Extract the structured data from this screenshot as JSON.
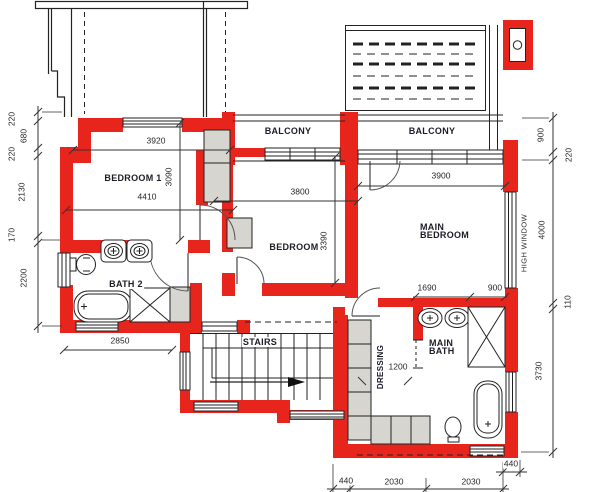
{
  "labels": {
    "bedroom1": "BEDROOM 1",
    "bedroom2": "BEDROOM 2",
    "main_bedroom_line1": "MAIN",
    "main_bedroom_line2": "BEDROOM",
    "bath2": "BATH 2",
    "main_bath_line1": "MAIN",
    "main_bath_line2": "BATH",
    "balcony_left": "BALCONY",
    "balcony_right": "BALCONY",
    "stairs": "STAIRS",
    "dressing": "DRESSING",
    "high_window": "HIGH WINDOW"
  },
  "dims": {
    "left": [
      "220",
      "680",
      "220",
      "2130",
      "170",
      "2200"
    ],
    "right": [
      "900",
      "220",
      "4000",
      "110",
      "3730"
    ],
    "bottom": [
      "440",
      "2030",
      "2030",
      "440"
    ],
    "bedroom1_top_wall": "3920",
    "bedroom1_width": "4410",
    "bedroom1_depth": "3090",
    "bedroom2_width": "3800",
    "bedroom2_depth": "3390",
    "main_bedroom_width": "3900",
    "vanity_width": "1690",
    "shower_width": "900",
    "bath2_width": "2850",
    "dressing_width": "1200"
  },
  "colors": {
    "wall_red": "#e8251d",
    "cupboard_gray": "#d6d5d0",
    "line": "#222222"
  }
}
